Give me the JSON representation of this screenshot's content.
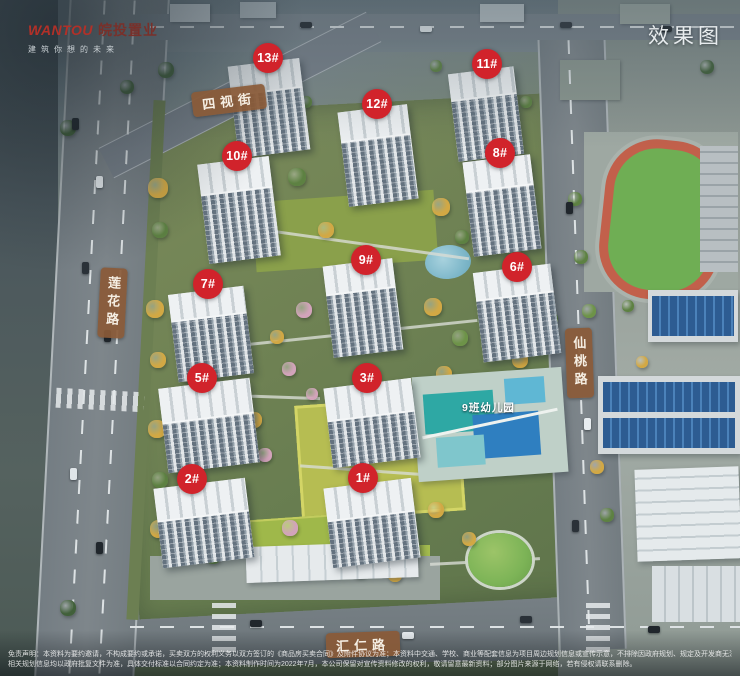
{
  "branding": {
    "logo_en": "WANTOU",
    "logo_cn": "皖投置业",
    "tagline": "建筑你想的未来"
  },
  "watermark_label": "效果图",
  "roads": {
    "north": {
      "label": "四视街"
    },
    "west": {
      "label": "莲花路"
    },
    "east": {
      "label": "仙桃路"
    },
    "south": {
      "label": "汇仁路"
    }
  },
  "buildings": [
    {
      "label": "13#"
    },
    {
      "label": "12#"
    },
    {
      "label": "11#"
    },
    {
      "label": "10#"
    },
    {
      "label": "8#"
    },
    {
      "label": "9#"
    },
    {
      "label": "6#"
    },
    {
      "label": "7#"
    },
    {
      "label": "5#"
    },
    {
      "label": "3#"
    },
    {
      "label": "2#"
    },
    {
      "label": "1#"
    }
  ],
  "poi": {
    "kindergarten_label": "9班幼儿园"
  },
  "disclaimer": {
    "line1": "免责声明：本资料为要约邀请，不构成要约或承诺，买卖双方的权利义务以双方签订的《商品房买卖合同》及附件协议为准；本资料中交通、学校、商业等配套信息为项目周边规划信息或宣传示意，不排除因政府规划、规定及开发商无法控制的原因发生变化，",
    "line2": "相关规划信息均以政府批复文件为准，具体交付标准以合同约定为准；本资料制作时间为2022年7月，本公司保留对宣传资料修改的权利，敬请留意最新资料；部分图片来源于网络，若有侵权请联系删除。"
  },
  "colors": {
    "badge_red": "#d1232b",
    "road_label_brown": "#8a5a38",
    "logo_red": "#b23028"
  }
}
